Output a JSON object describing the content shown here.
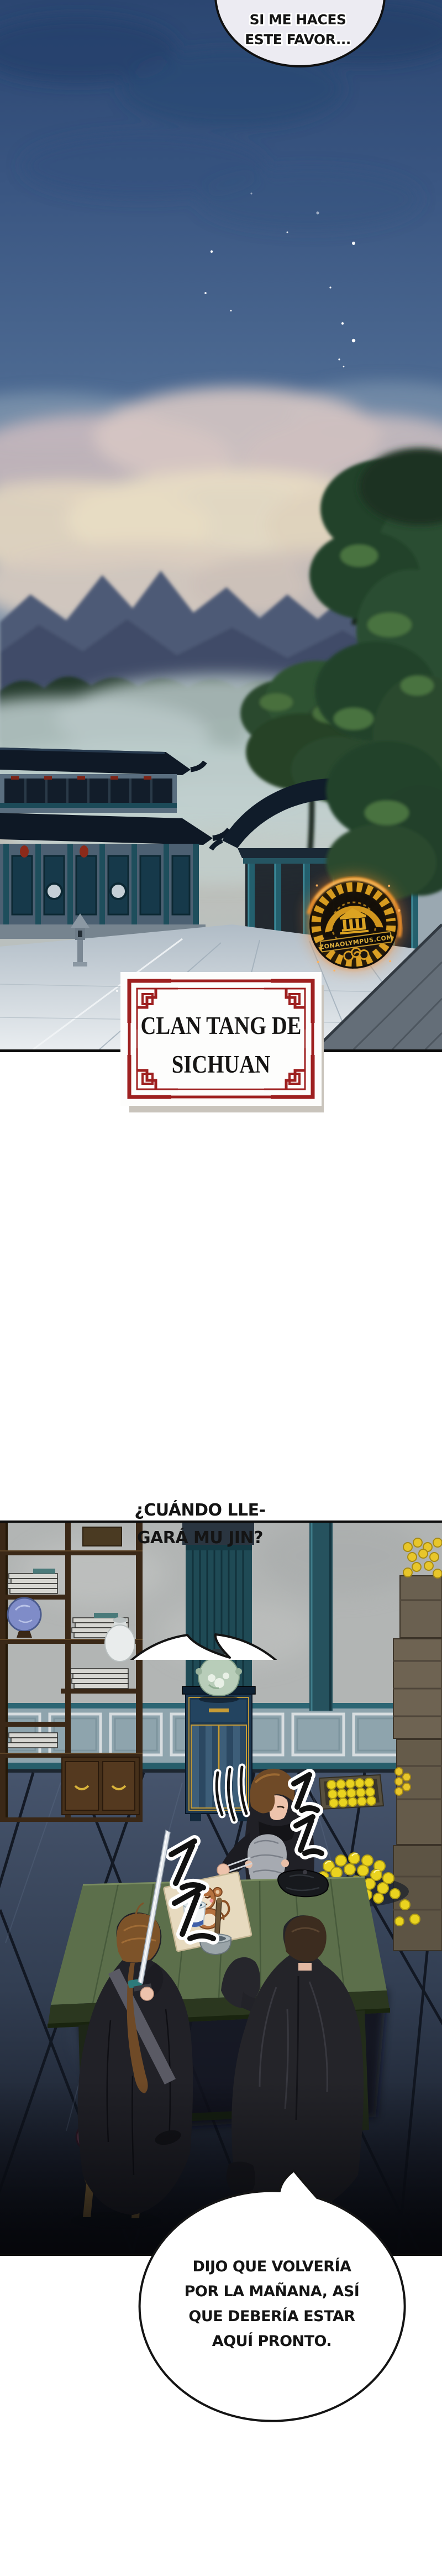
{
  "speech_bubbles": {
    "top": {
      "line1": "SI ME HACES",
      "line2": "ESTE FAVOR..."
    },
    "middle": {
      "line1": "¿CUÁNDO LLE-",
      "line2": "GARÁ MU JIN?"
    },
    "bottom": {
      "line1": "DIJO QUE VOLVERÍA",
      "line2": "POR LA MAÑANA, ASÍ",
      "line3": "QUE DEBERÍA ESTAR",
      "line4": "AQUÍ PRONTO."
    }
  },
  "location_label": {
    "line1": "CLAN TANG DE",
    "line2": "SICHUAN",
    "border_color": "#9e2020"
  },
  "watermark_seal": {
    "arc_text": "LEE ANTES",
    "banner_text": "ZONAOLYMPUS.COM",
    "gold": "#dd9f1f",
    "glow": "#ff8a1e"
  },
  "colors": {
    "sky_top": "#2b4671",
    "sky_mid": "#5f7da2",
    "cloud_pink": "#d6c7c3",
    "mountain": "#4e5a76",
    "forest": "#23392c",
    "roof_navy": "#101c2a",
    "pillar_teal": "#235f6d",
    "courtyard_gray": "#e6ebef",
    "interior_wall": "#b2b5b4",
    "floor_navy": "#3d4c63",
    "table_green": "#5c6f4b",
    "coin_yellow": "#e9d826",
    "robe_dark": "#232329",
    "stool_maroon": "#543142",
    "bubble_fill": "#ffffff"
  }
}
